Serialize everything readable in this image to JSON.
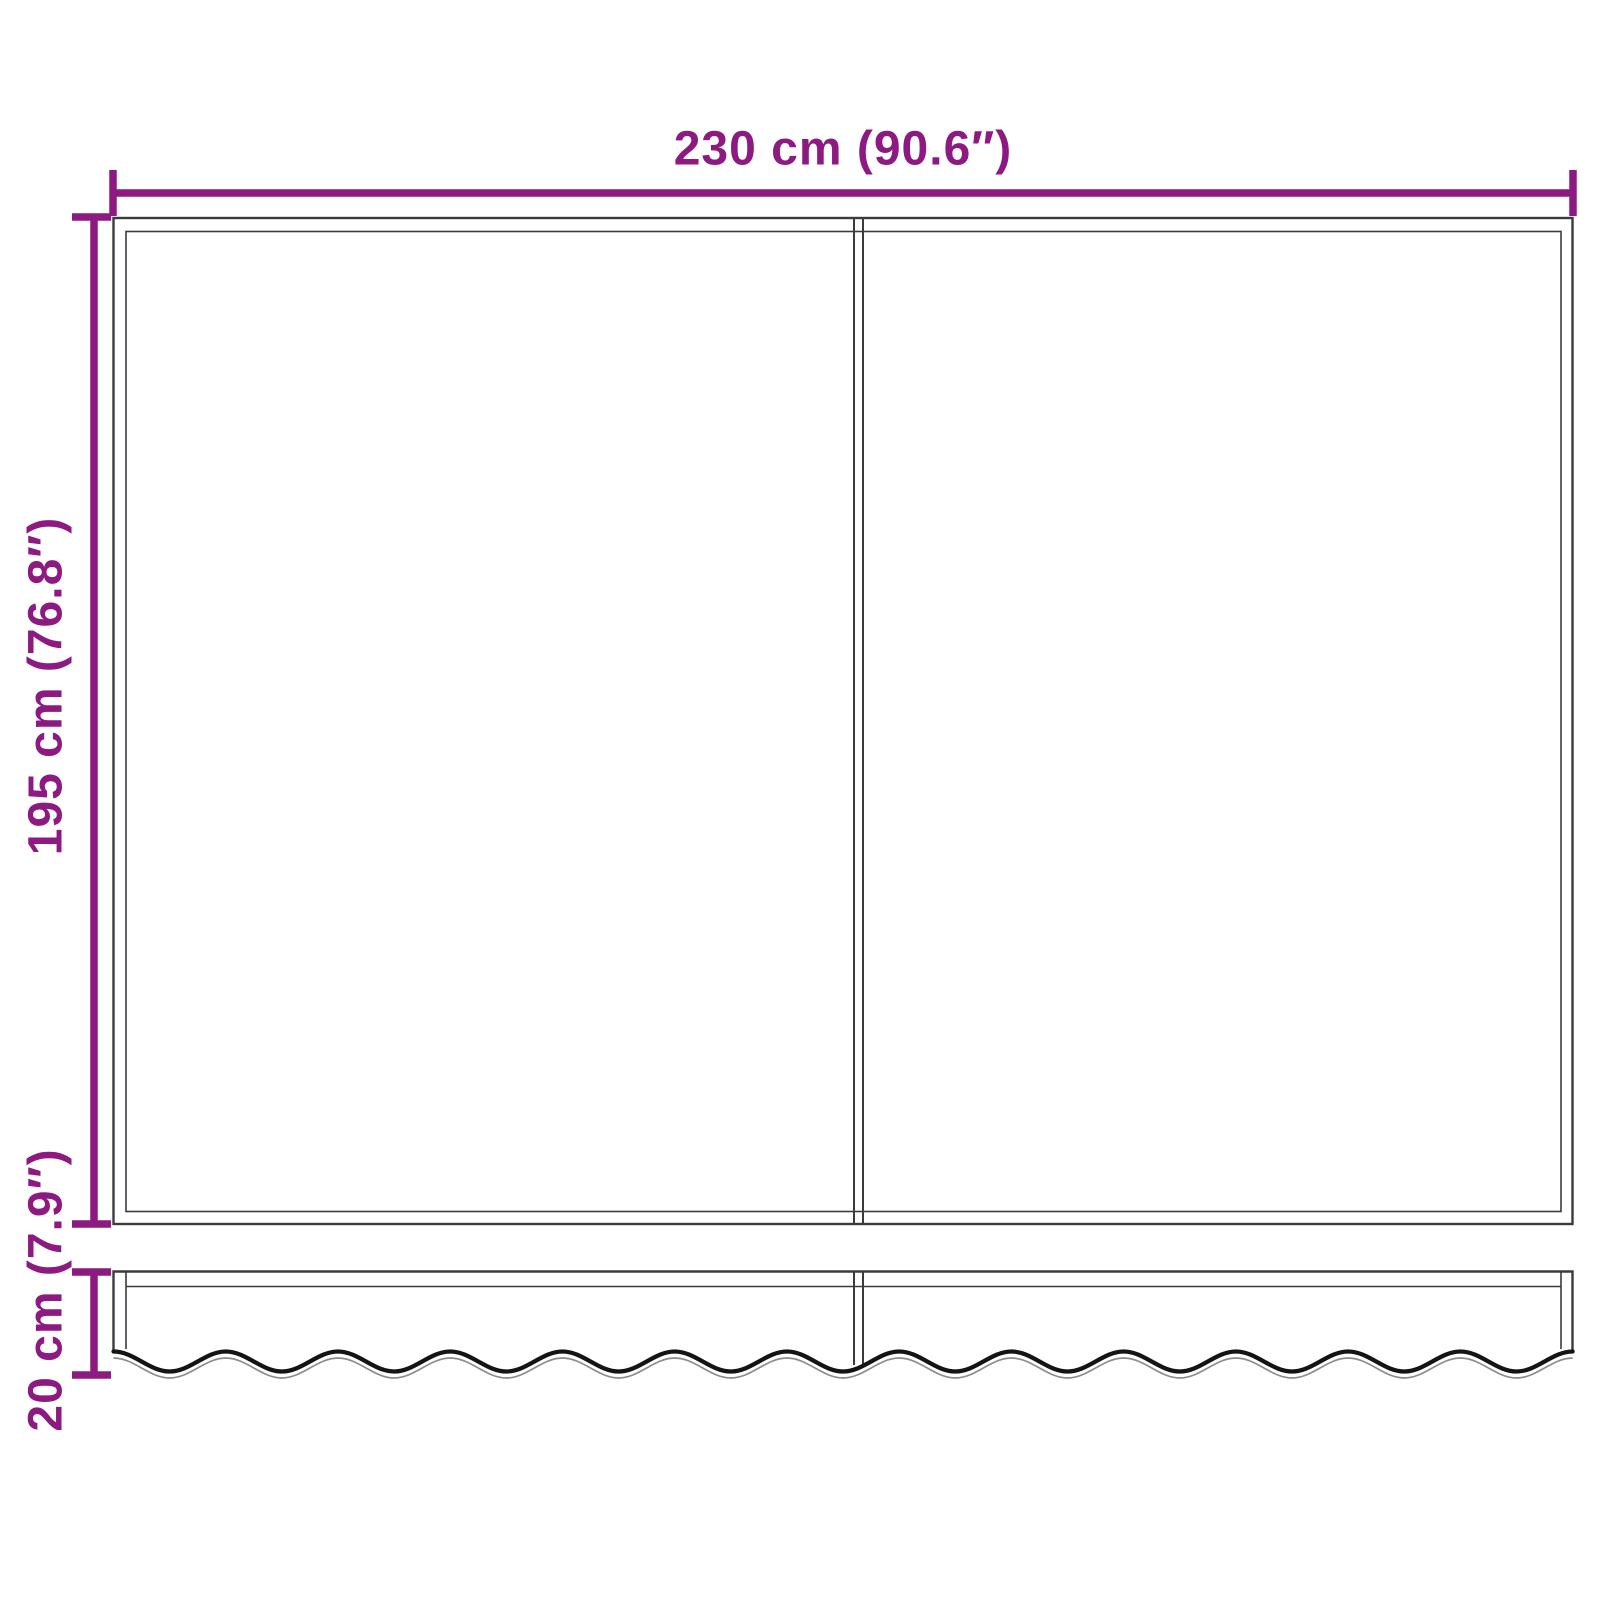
{
  "diagram": {
    "labels": {
      "width": "230 cm (90.6″)",
      "height": "195 cm (76.8″)",
      "valance_height": "20 cm (7.9″)"
    },
    "colors": {
      "dimension": "#8C1A80",
      "outline": "#3B3B3B",
      "wave_dark": "#141414",
      "wave_light": "#8C8C8C",
      "background": "#FFFFFF"
    }
  }
}
